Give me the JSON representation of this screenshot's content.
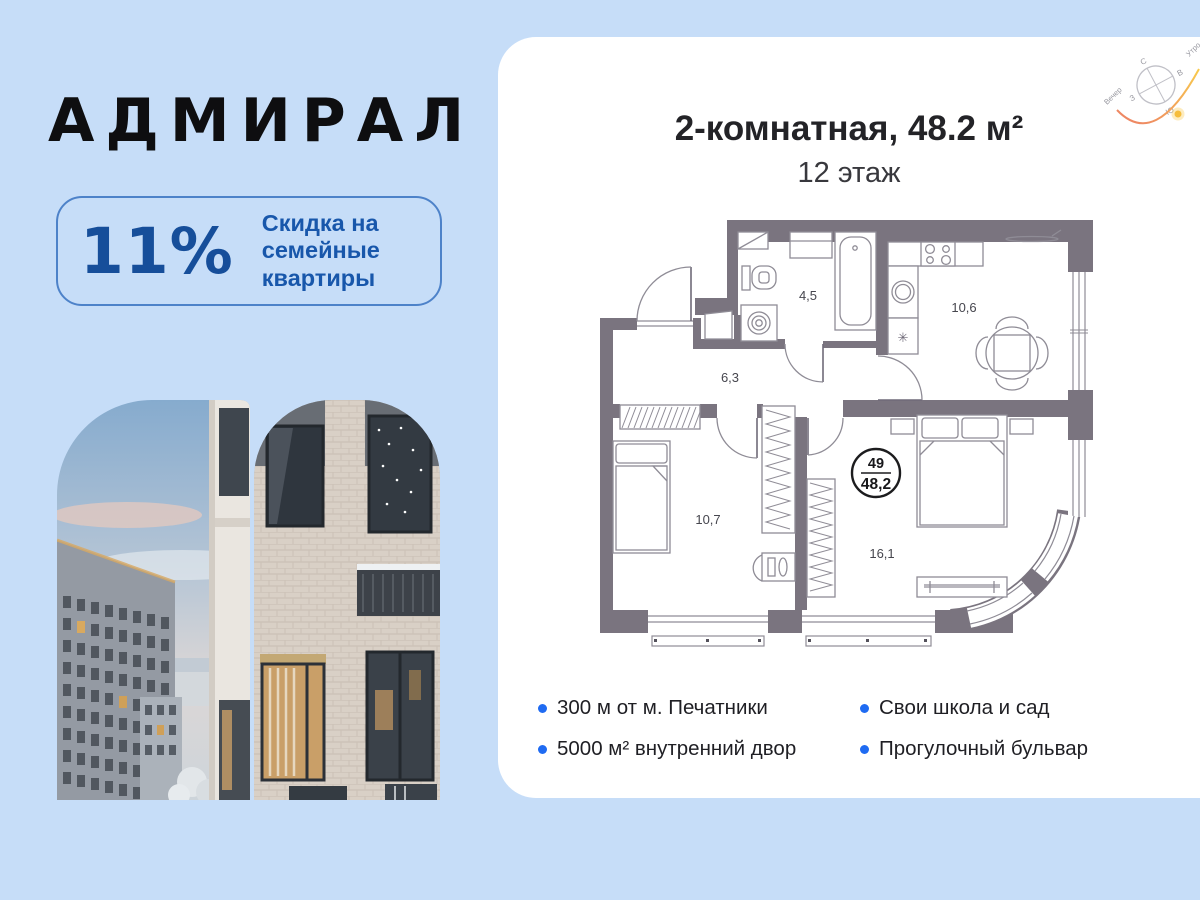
{
  "page": {
    "background": "#c6ddf8"
  },
  "logo": {
    "text": "АДМИРАЛ"
  },
  "badge": {
    "percent": "11%",
    "lines": [
      "Скидка на",
      "семейные",
      "квартиры"
    ],
    "accent_color": "#164e9a"
  },
  "card": {
    "title": "2-комнатная, 48.2 м²",
    "floor": "12 этаж",
    "compass": {
      "n": "С",
      "e": "В",
      "s": "Ю",
      "w": "З",
      "evening": "Вечер",
      "morning": "Утро"
    },
    "floorplan": {
      "wall_color": "#7a747f",
      "rooms": [
        {
          "name": "bathroom",
          "area": "4,5"
        },
        {
          "name": "kitchen-living",
          "area": "10,6"
        },
        {
          "name": "hallway",
          "area": "6,3"
        },
        {
          "name": "bedroom",
          "area": "10,7"
        },
        {
          "name": "bedroom-main",
          "area": "16,1"
        }
      ],
      "unit_badge": {
        "number": "49",
        "area": "48,2"
      }
    },
    "features": [
      "300 м от м. Печатники",
      "5000 м² внутренний двор",
      "Свои школа и сад",
      "Прогулочный бульвар"
    ]
  }
}
